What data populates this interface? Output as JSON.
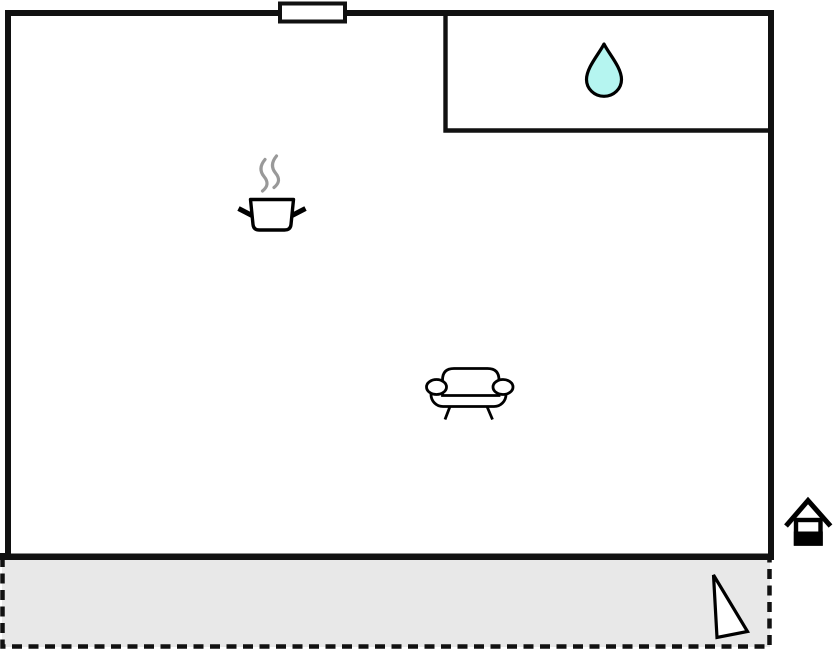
{
  "plan": {
    "kind": "floor-plan",
    "canvas": {
      "width": 834,
      "height": 652
    }
  },
  "palette": {
    "background": "#ffffff",
    "wall": "#111111",
    "room_fill": "#ffffff",
    "terrace_fill": "#e8e8e8",
    "terrace_border": "#111111",
    "water_drop_fill": "#b5f5f0",
    "steam": "#999999",
    "icon_stroke": "#000000",
    "icon_fill": "#ffffff"
  },
  "icons": {
    "window": "window-symbol",
    "water_drop": "water-drop-icon",
    "cooking_pot": "cooking-pot-icon",
    "sofa": "sofa-icon",
    "house": "house-icon",
    "triangle": "triangle-marker-icon"
  }
}
